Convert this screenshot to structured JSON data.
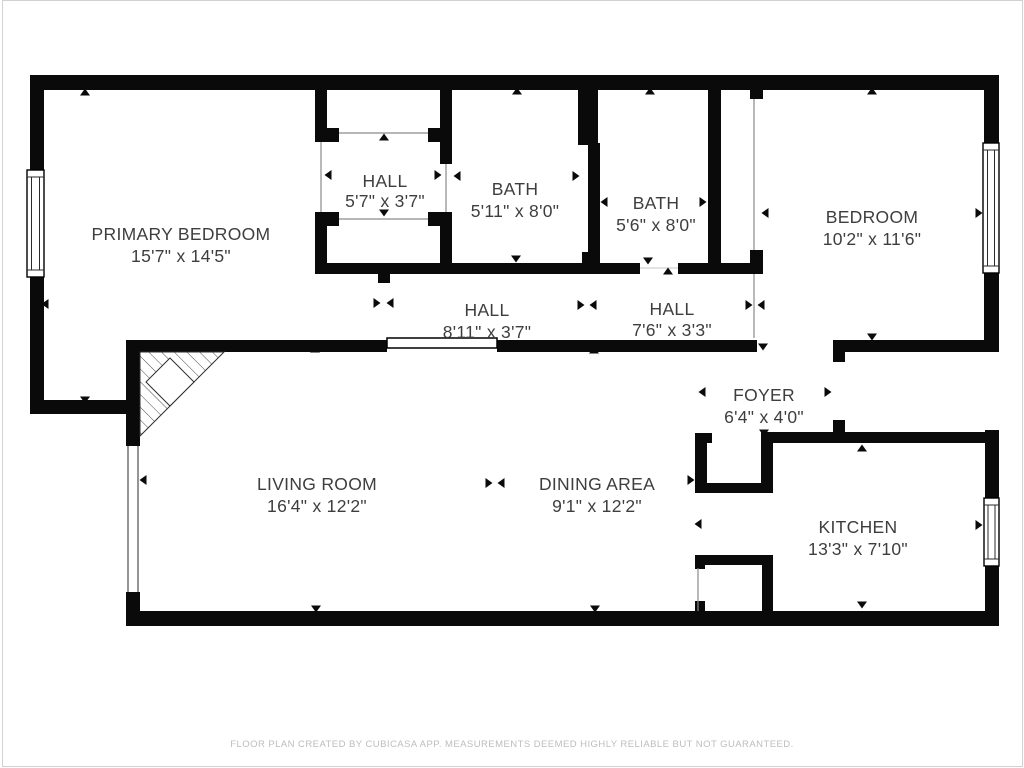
{
  "colors": {
    "wall": "#0a0a0a",
    "room_text": "#3e3e3e",
    "footer_text": "#bdbdbd",
    "background": "#ffffff"
  },
  "rooms": [
    {
      "name": "PRIMARY BEDROOM",
      "size": "15'7\" x 14'5\""
    },
    {
      "name": "HALL",
      "size": "5'7\" x 3'7\""
    },
    {
      "name": "BATH",
      "size": "5'11\" x 8'0\""
    },
    {
      "name": "BATH",
      "size": "5'6\" x 8'0\""
    },
    {
      "name": "BEDROOM",
      "size": "10'2\" x 11'6\""
    },
    {
      "name": "HALL",
      "size": "8'11\" x 3'7\""
    },
    {
      "name": "HALL",
      "size": "7'6\" x 3'3\""
    },
    {
      "name": "FOYER",
      "size": "6'4\" x 4'0\""
    },
    {
      "name": "LIVING ROOM",
      "size": "16'4\" x 12'2\""
    },
    {
      "name": "DINING AREA",
      "size": "9'1\" x 12'2\""
    },
    {
      "name": "KITCHEN",
      "size": "13'3\" x 7'10\""
    }
  ],
  "footer": {
    "disclaimer": "FLOOR PLAN CREATED BY CUBICASA APP. MEASUREMENTS DEEMED HIGHLY RELIABLE BUT NOT GUARANTEED."
  }
}
